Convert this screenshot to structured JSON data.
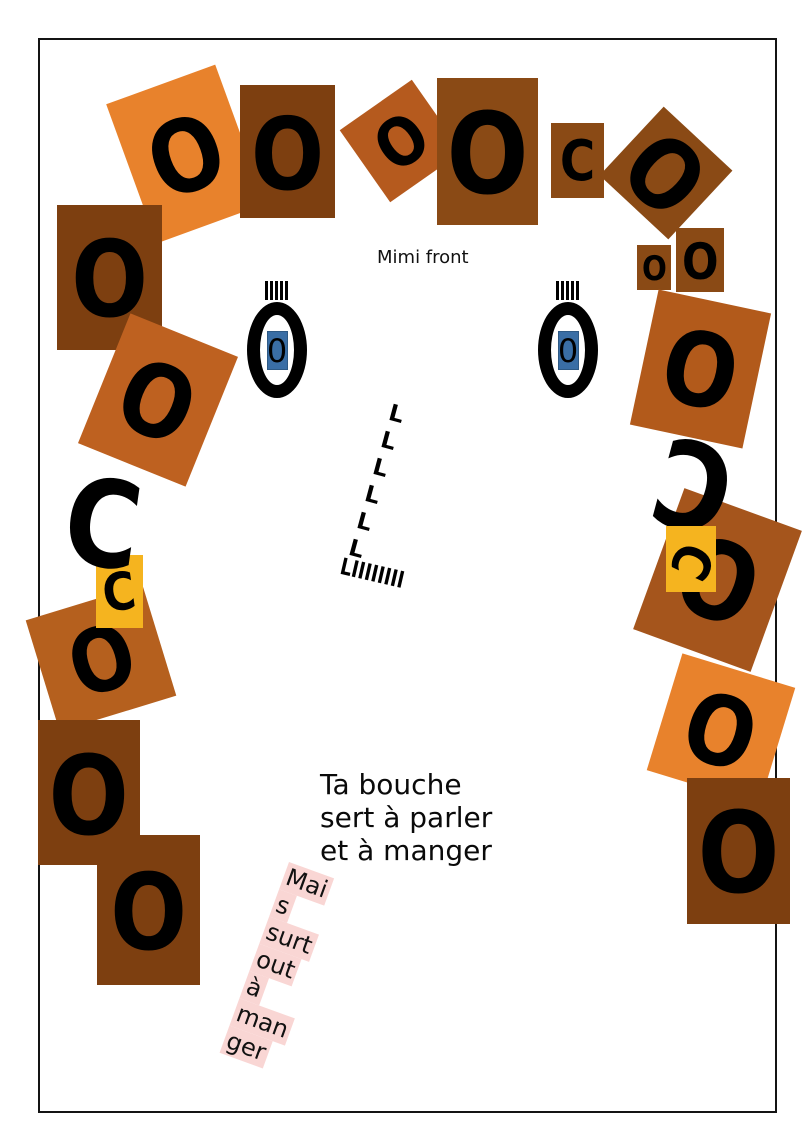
{
  "face": {
    "label": "Mimi front",
    "palette": {
      "orange": "#E8822C",
      "dark_brown": "#7D3F10",
      "brown": "#8A4A15",
      "rust": "#B25A1B",
      "yellow": "#F5B41F",
      "eye_blue": "#3A6EA5",
      "mouth_pink": "#F9D6D4"
    },
    "hair_tiles": [
      {
        "letter": "O",
        "bg": "#E8822C",
        "x": 128,
        "y": 80,
        "w": 116,
        "h": 148,
        "rot": -20,
        "fs": 100
      },
      {
        "letter": "O",
        "bg": "#7D3F10",
        "x": 240,
        "y": 85,
        "w": 95,
        "h": 133,
        "rot": 0,
        "fs": 100
      },
      {
        "letter": "O",
        "bg": "#B55A1E",
        "x": 357,
        "y": 97,
        "w": 88,
        "h": 88,
        "rot": -35,
        "fs": 66
      },
      {
        "letter": "O",
        "bg": "#8A4A15",
        "x": 437,
        "y": 78,
        "w": 101,
        "h": 147,
        "rot": 0,
        "fs": 112
      },
      {
        "letter": "C",
        "bg": "#8A4A15",
        "x": 551,
        "y": 123,
        "w": 53,
        "h": 75,
        "rot": 0,
        "fs": 56
      },
      {
        "letter": "O",
        "bg": "#8A4A15",
        "x": 619,
        "y": 126,
        "w": 94,
        "h": 94,
        "rot": 43,
        "fs": 96
      },
      {
        "letter": "O",
        "bg": "#8A4A15",
        "x": 637,
        "y": 245,
        "w": 34,
        "h": 45,
        "rot": 0,
        "fs": 34
      },
      {
        "letter": "O",
        "bg": "#8A4A15",
        "x": 676,
        "y": 228,
        "w": 48,
        "h": 64,
        "rot": 0,
        "fs": 50
      },
      {
        "letter": "O",
        "bg": "#B25A1B",
        "x": 643,
        "y": 300,
        "w": 115,
        "h": 138,
        "rot": 12,
        "fs": 102
      },
      {
        "letter": "O",
        "bg": "#A5551C",
        "x": 655,
        "y": 505,
        "w": 125,
        "h": 150,
        "rot": 20,
        "fs": 108
      },
      {
        "letter": "C",
        "bg": "none",
        "x": 648,
        "y": 430,
        "w": 92,
        "h": 98,
        "rot": 0,
        "fs": 120,
        "letter_rot": 195
      },
      {
        "letter": "C",
        "bg": "#F5B41F",
        "x": 666,
        "y": 526,
        "w": 50,
        "h": 66,
        "rot": 0,
        "fs": 52,
        "letter_rot": 115
      },
      {
        "letter": "O",
        "bg": "#E8822C",
        "x": 662,
        "y": 668,
        "w": 118,
        "h": 122,
        "rot": 17,
        "fs": 96
      },
      {
        "letter": "O",
        "bg": "#7D3F10",
        "x": 687,
        "y": 778,
        "w": 103,
        "h": 146,
        "rot": 0,
        "fs": 112
      },
      {
        "letter": "O",
        "bg": "#7D3F10",
        "x": 57,
        "y": 205,
        "w": 105,
        "h": 145,
        "rot": 0,
        "fs": 105
      },
      {
        "letter": "O",
        "bg": "#BE6120",
        "x": 100,
        "y": 330,
        "w": 116,
        "h": 140,
        "rot": 22,
        "fs": 100
      },
      {
        "letter": "O",
        "bg": "#B5601E",
        "x": 40,
        "y": 600,
        "w": 122,
        "h": 116,
        "rot": -17,
        "fs": 88
      },
      {
        "letter": "C",
        "bg": "#F5B41F",
        "x": 96,
        "y": 555,
        "w": 47,
        "h": 73,
        "rot": 0,
        "fs": 52,
        "letter_rot": -8
      },
      {
        "letter": "C",
        "bg": "none",
        "x": 58,
        "y": 470,
        "w": 90,
        "h": 105,
        "rot": 8,
        "fs": 120
      },
      {
        "letter": "O",
        "bg": "#7D3F10",
        "x": 38,
        "y": 720,
        "w": 102,
        "h": 145,
        "rot": 0,
        "fs": 110
      },
      {
        "letter": "O",
        "bg": "#7D3F10",
        "x": 97,
        "y": 835,
        "w": 103,
        "h": 150,
        "rot": 0,
        "fs": 105
      }
    ],
    "eyes": {
      "lashes": "IIIII",
      "pupil": "0",
      "pupil_bg": "#3A6EA5"
    },
    "nose": {
      "glyph": "L",
      "positions": [
        {
          "x": 392,
          "y": 402
        },
        {
          "x": 384,
          "y": 429
        },
        {
          "x": 376,
          "y": 456
        },
        {
          "x": 368,
          "y": 483
        },
        {
          "x": 360,
          "y": 510
        },
        {
          "x": 352,
          "y": 537
        }
      ],
      "base_row": "LIIIIIIII"
    },
    "mouth": {
      "lines": [
        "Ta bouche",
        "sert à parler",
        "et à manger"
      ],
      "highlight_lines": [
        "Mai",
        "s",
        "surt",
        "out",
        "à",
        "man",
        "ger"
      ],
      "highlight_color": "#F9D6D4"
    }
  }
}
